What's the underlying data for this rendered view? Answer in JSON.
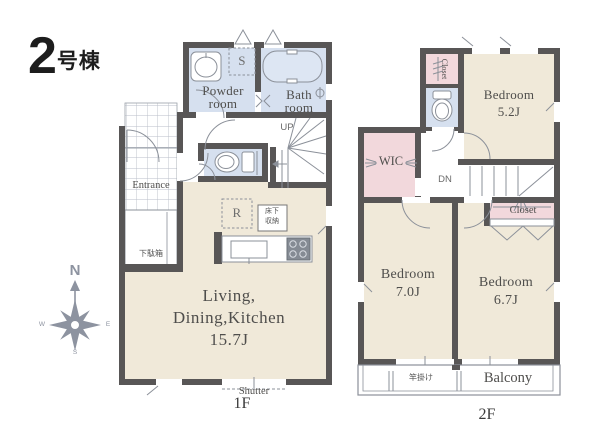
{
  "title": {
    "number": "2",
    "suffix": "号棟"
  },
  "compass": {
    "north": "N",
    "east": "E",
    "south": "S",
    "west": "W"
  },
  "colors": {
    "wall": "#585656",
    "room_beige": "#f0e9d9",
    "wet_room_blue": "#d6e0ef",
    "closet_pink": "#f2d8dc",
    "fixture_line": "#8b9099",
    "label_text": "#4f4e4c"
  },
  "floor1": {
    "floor_label": "1F",
    "powder_room": {
      "line1": "Powder",
      "line2": "room"
    },
    "bath_room": {
      "line1": "Bath",
      "line2": "room"
    },
    "storage_s": "S",
    "refrigerator_r": "R",
    "underfloor_storage": {
      "line1": "床下",
      "line2": "収納"
    },
    "entrance": "Entrance",
    "shoe_cabinet": "下駄箱",
    "ldk": {
      "line1": "Living,",
      "line2": "Dining,Kitchen",
      "size": "15.7J"
    },
    "stairs_up": "UP",
    "shutter": "Shutter"
  },
  "floor2": {
    "floor_label": "2F",
    "bedroom_1": {
      "name": "Bedroom",
      "size": "5.2J"
    },
    "bedroom_2": {
      "name": "Bedroom",
      "size": "7.0J"
    },
    "bedroom_3": {
      "name": "Bedroom",
      "size": "6.7J"
    },
    "closet_upper": "Closet",
    "closet_lower": "Closet",
    "wic": "WIC",
    "stairs_down": "DN",
    "balcony": "Balcony",
    "pole_hanger": "竿掛け"
  }
}
